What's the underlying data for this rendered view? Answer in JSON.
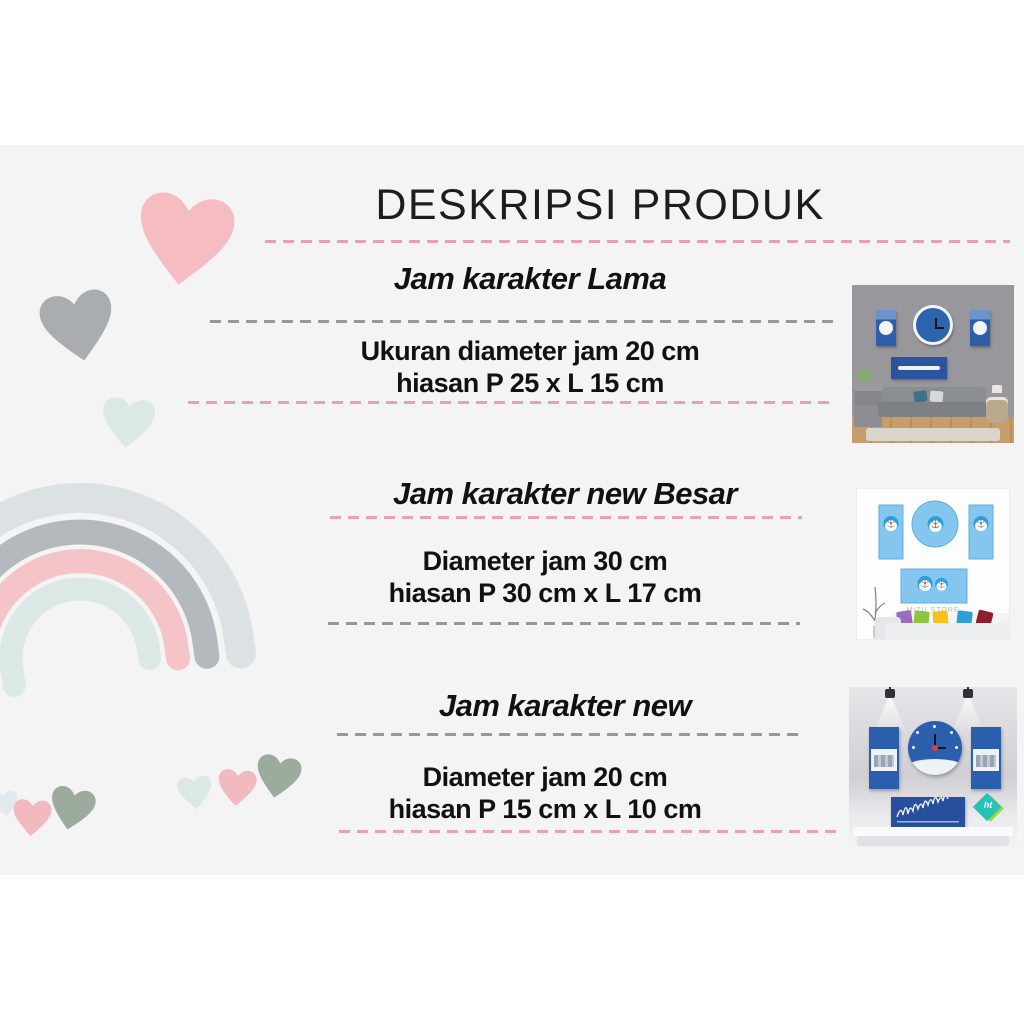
{
  "page": {
    "title": "DESKRIPSI PRODUK"
  },
  "sections": [
    {
      "heading": "Jam karakter Lama",
      "spec1": "Ukuran diameter jam 20 cm",
      "spec2": "hiasan P 25 x L 15 cm"
    },
    {
      "heading": "Jam karakter new Besar",
      "spec1": "Diameter jam 30 cm",
      "spec2": "hiasan P 30 cm x L 17 cm"
    },
    {
      "heading": "Jam karakter new",
      "spec1": "Diameter jam 20 cm",
      "spec2": "hiasan P 15 cm x L 10 cm"
    }
  ],
  "photos": [
    {
      "name": "jam-karakter-lama",
      "watermark": ""
    },
    {
      "name": "jam-karakter-new-besar",
      "watermark": "MIZU STORE"
    },
    {
      "name": "jam-karakter-new",
      "watermark": ""
    }
  ],
  "colors": {
    "card_background": "#f4f4f5",
    "page_background": "#ffffff",
    "title_text": "#1d1d1f",
    "dash_pink": "#e9a2a8",
    "dash_gray": "#97979c",
    "heart_pink": "#f5bcc2",
    "heart_gray": "#a9adb0",
    "heart_mint": "#dce8e4",
    "heart_sage": "#9cab9e",
    "rainbow_outer_gray": "#dce1e4",
    "rainbow_gray": "#b3b9bc",
    "rainbow_pink": "#f5c4c9",
    "rainbow_mint": "#dce8e5",
    "clock_blue_dark": "#2c5eae",
    "clock_blue_light": "#85c6ee",
    "badge_teal": "#27c2b4",
    "badge_lime": "#9fd63a"
  }
}
